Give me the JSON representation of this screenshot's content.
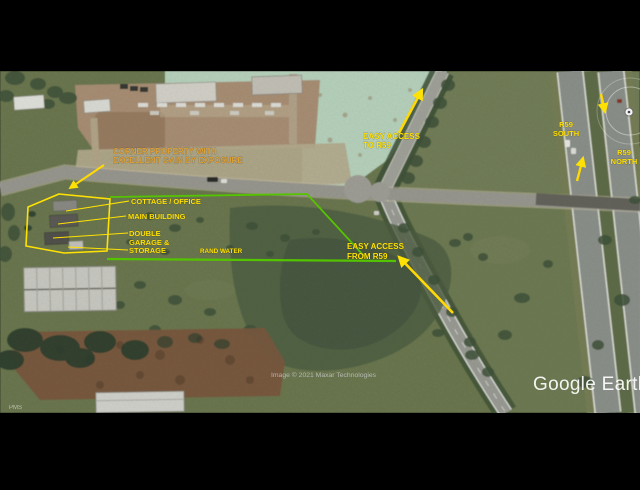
{
  "app": {
    "watermark": "Google Earth",
    "attribution": "Image © 2021 Maxar Technologies",
    "corner_fragment": "PMS"
  },
  "annotations": {
    "corner_property": {
      "line1": "CORNER PROPERTY WITH",
      "line2": "EXCELLENT GAIN BY EXPOSURE"
    },
    "buildings": {
      "cottage": "COTTAGE / OFFICE",
      "main": "MAIN BUILDING",
      "garage_line1": "DOUBLE",
      "garage_line2": "GARAGE &",
      "garage_line3": "STORAGE"
    },
    "rand_water": "RAND WATER",
    "access_to": {
      "line1": "EASY ACCESS",
      "line2": "TO R59"
    },
    "access_from": {
      "line1": "EASY ACCESS",
      "line2": "FROM R59"
    },
    "r59_south": {
      "line1": "R59",
      "line2": "SOUTH"
    },
    "r59_north": {
      "line1": "R59",
      "line2": "NORTH"
    }
  },
  "colors": {
    "annotation_yellow": "#FFE204",
    "annotation_orange": "#DD9F38",
    "boundary_yellow": "#FFE204",
    "boundary_green": "#55C400",
    "arrow_yellow": "#FFD903",
    "watermark_white": "#FFFFFF",
    "attribution_grey": "#C9C9C9"
  }
}
